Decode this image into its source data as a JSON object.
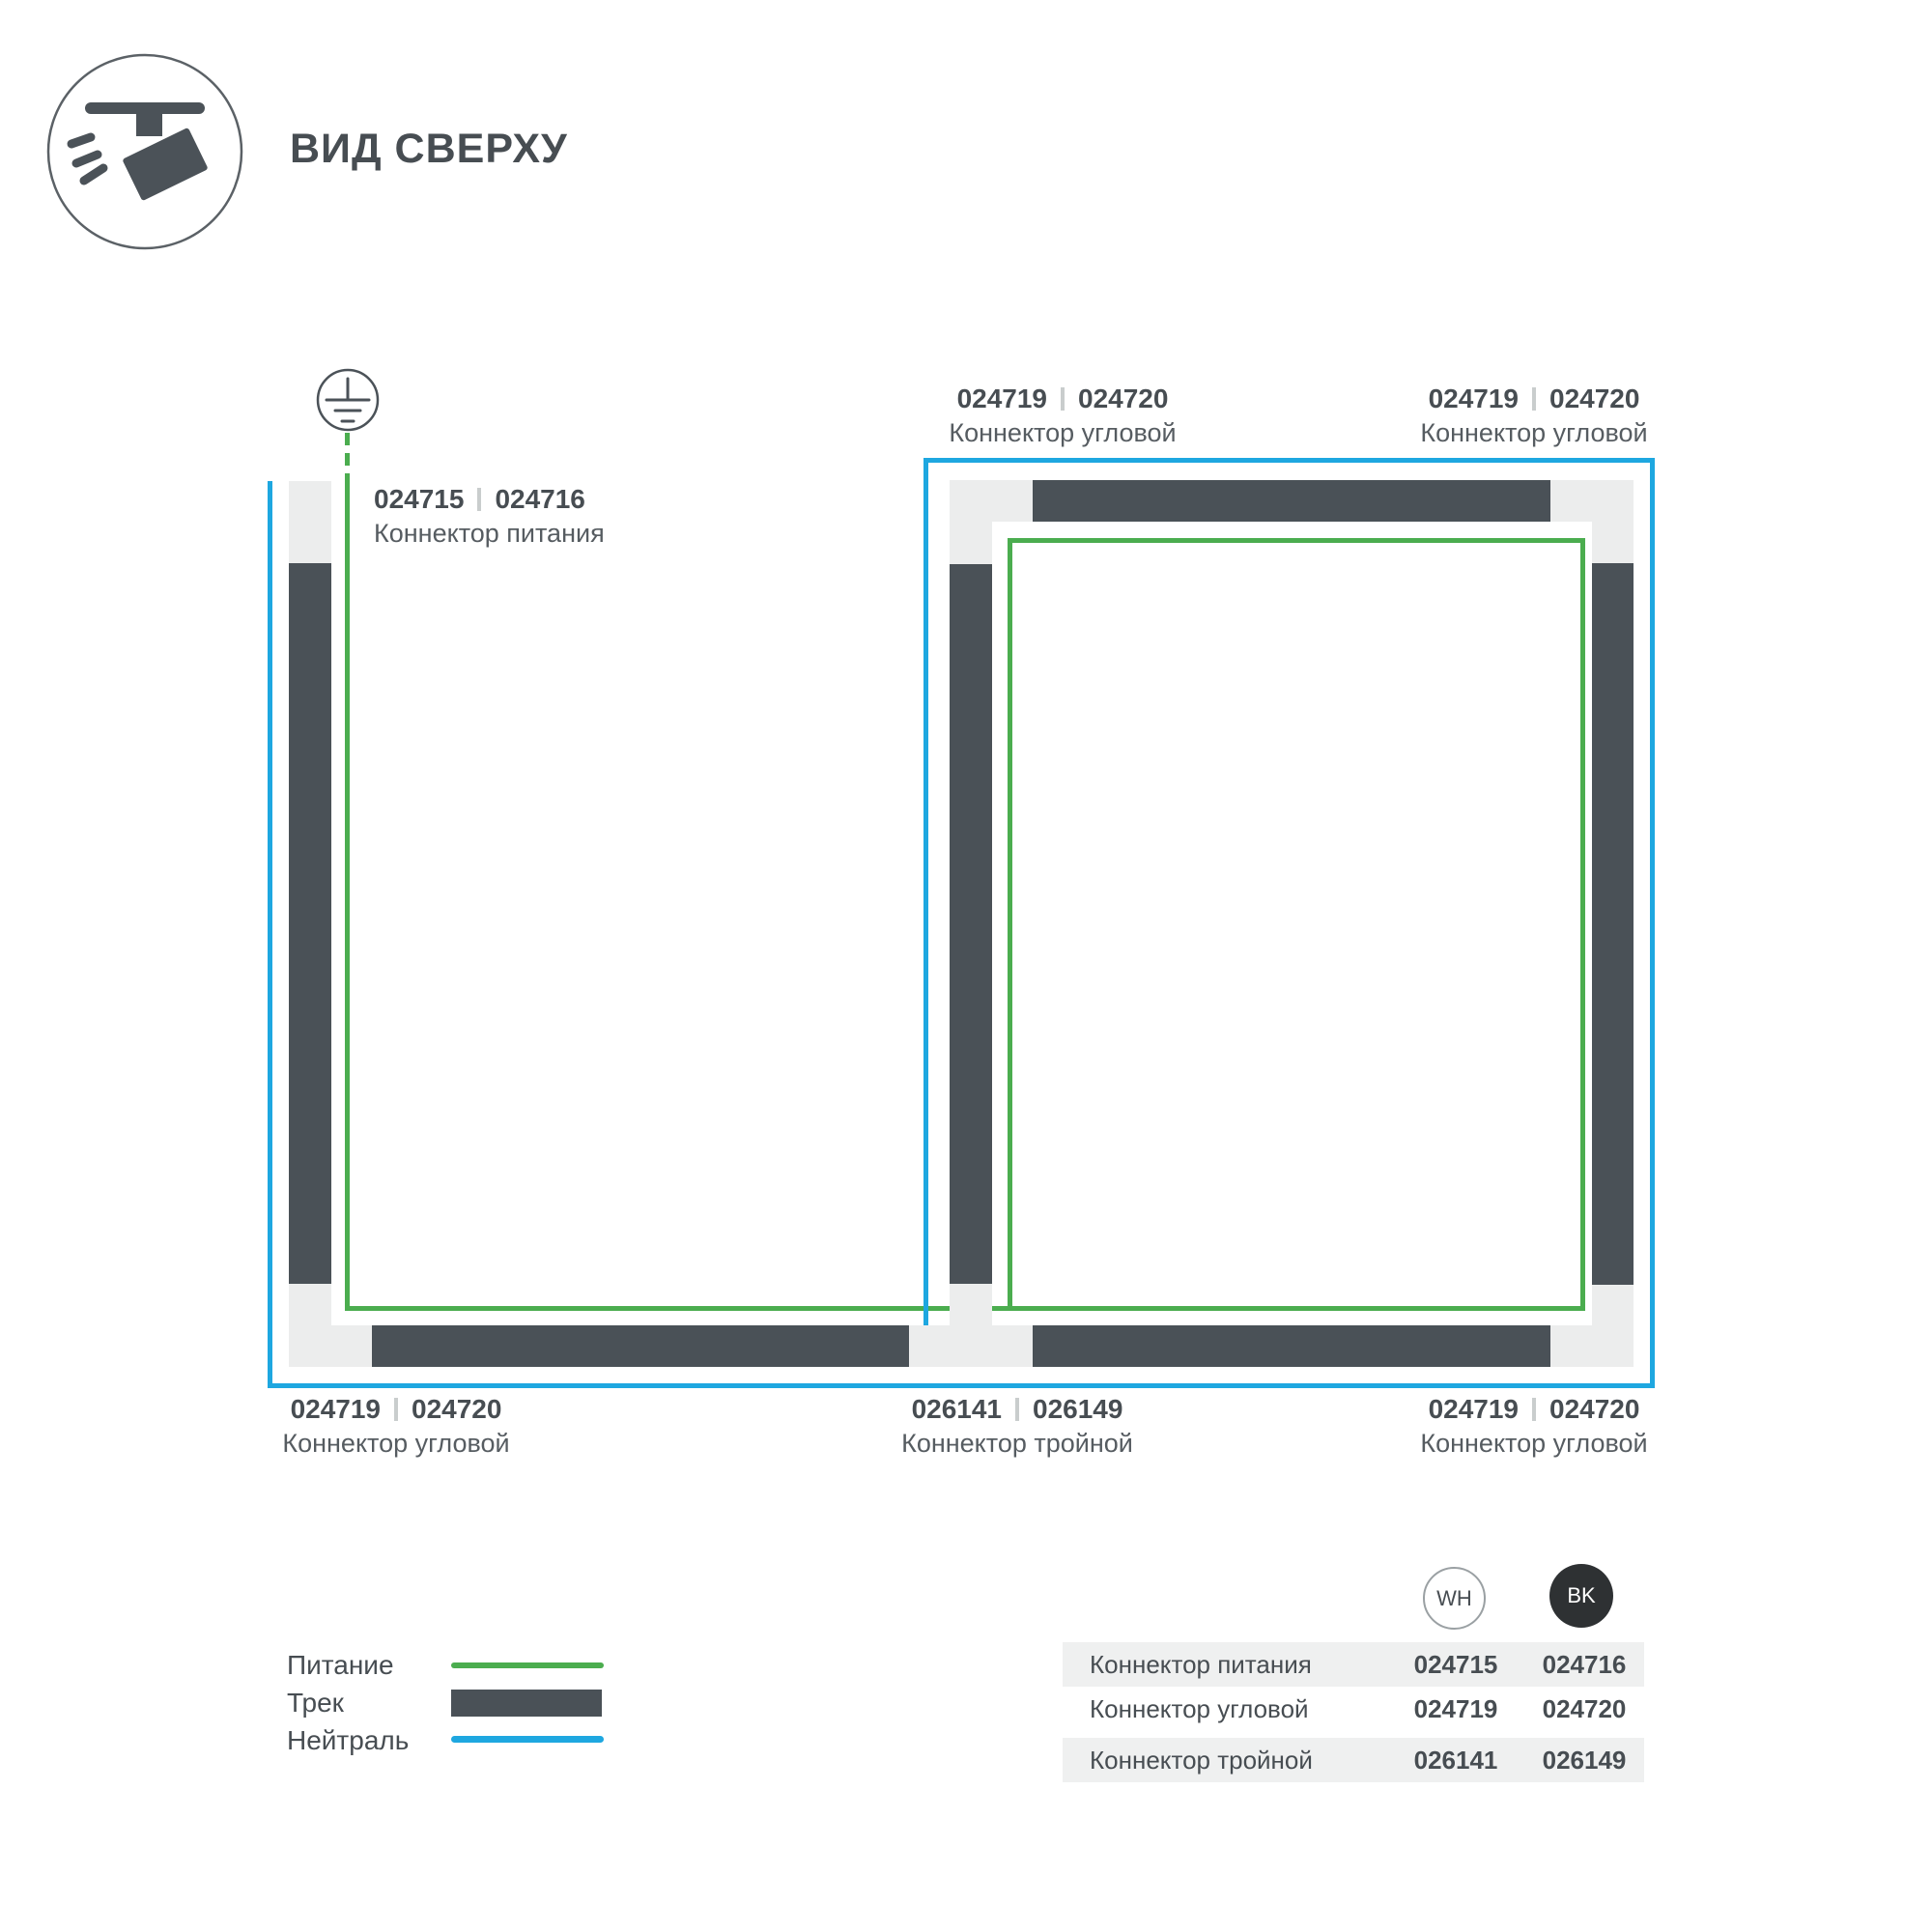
{
  "header": {
    "title": "ВИД СВЕРХУ"
  },
  "colors": {
    "power": "#4bad4f",
    "neutral": "#1ea7e0",
    "track": "#4a5157",
    "connector": "#eceded",
    "stripe": "#eff0f0",
    "text_dark": "#474d52",
    "text_mid": "#565c61",
    "separator": "#c9cdcd",
    "bk_fill": "#2e3133",
    "badge_border": "#9aa0a3",
    "icon": "#4b5258"
  },
  "labels": {
    "power": {
      "codes": [
        "024715",
        "024716"
      ],
      "name": "Коннектор питания"
    },
    "corner_tl": {
      "codes": [
        "024719",
        "024720"
      ],
      "name": "Коннектор угловой"
    },
    "corner_tr": {
      "codes": [
        "024719",
        "024720"
      ],
      "name": "Коннектор угловой"
    },
    "corner_bl": {
      "codes": [
        "024719",
        "024720"
      ],
      "name": "Коннектор угловой"
    },
    "triple": {
      "codes": [
        "026141",
        "026149"
      ],
      "name": "Коннектор тройной"
    },
    "corner_br": {
      "codes": [
        "024719",
        "024720"
      ],
      "name": "Коннектор угловой"
    }
  },
  "legend": {
    "items": [
      {
        "label": "Питание"
      },
      {
        "label": "Трек"
      },
      {
        "label": "Нейтраль"
      }
    ]
  },
  "table": {
    "columns": [
      "WH",
      "BK"
    ],
    "rows": [
      {
        "name": "Коннектор питания",
        "wh": "024715",
        "bk": "024716"
      },
      {
        "name": "Коннектор угловой",
        "wh": "024719",
        "bk": "024720"
      },
      {
        "name": "Коннектор тройной",
        "wh": "026141",
        "bk": "026149"
      }
    ]
  }
}
